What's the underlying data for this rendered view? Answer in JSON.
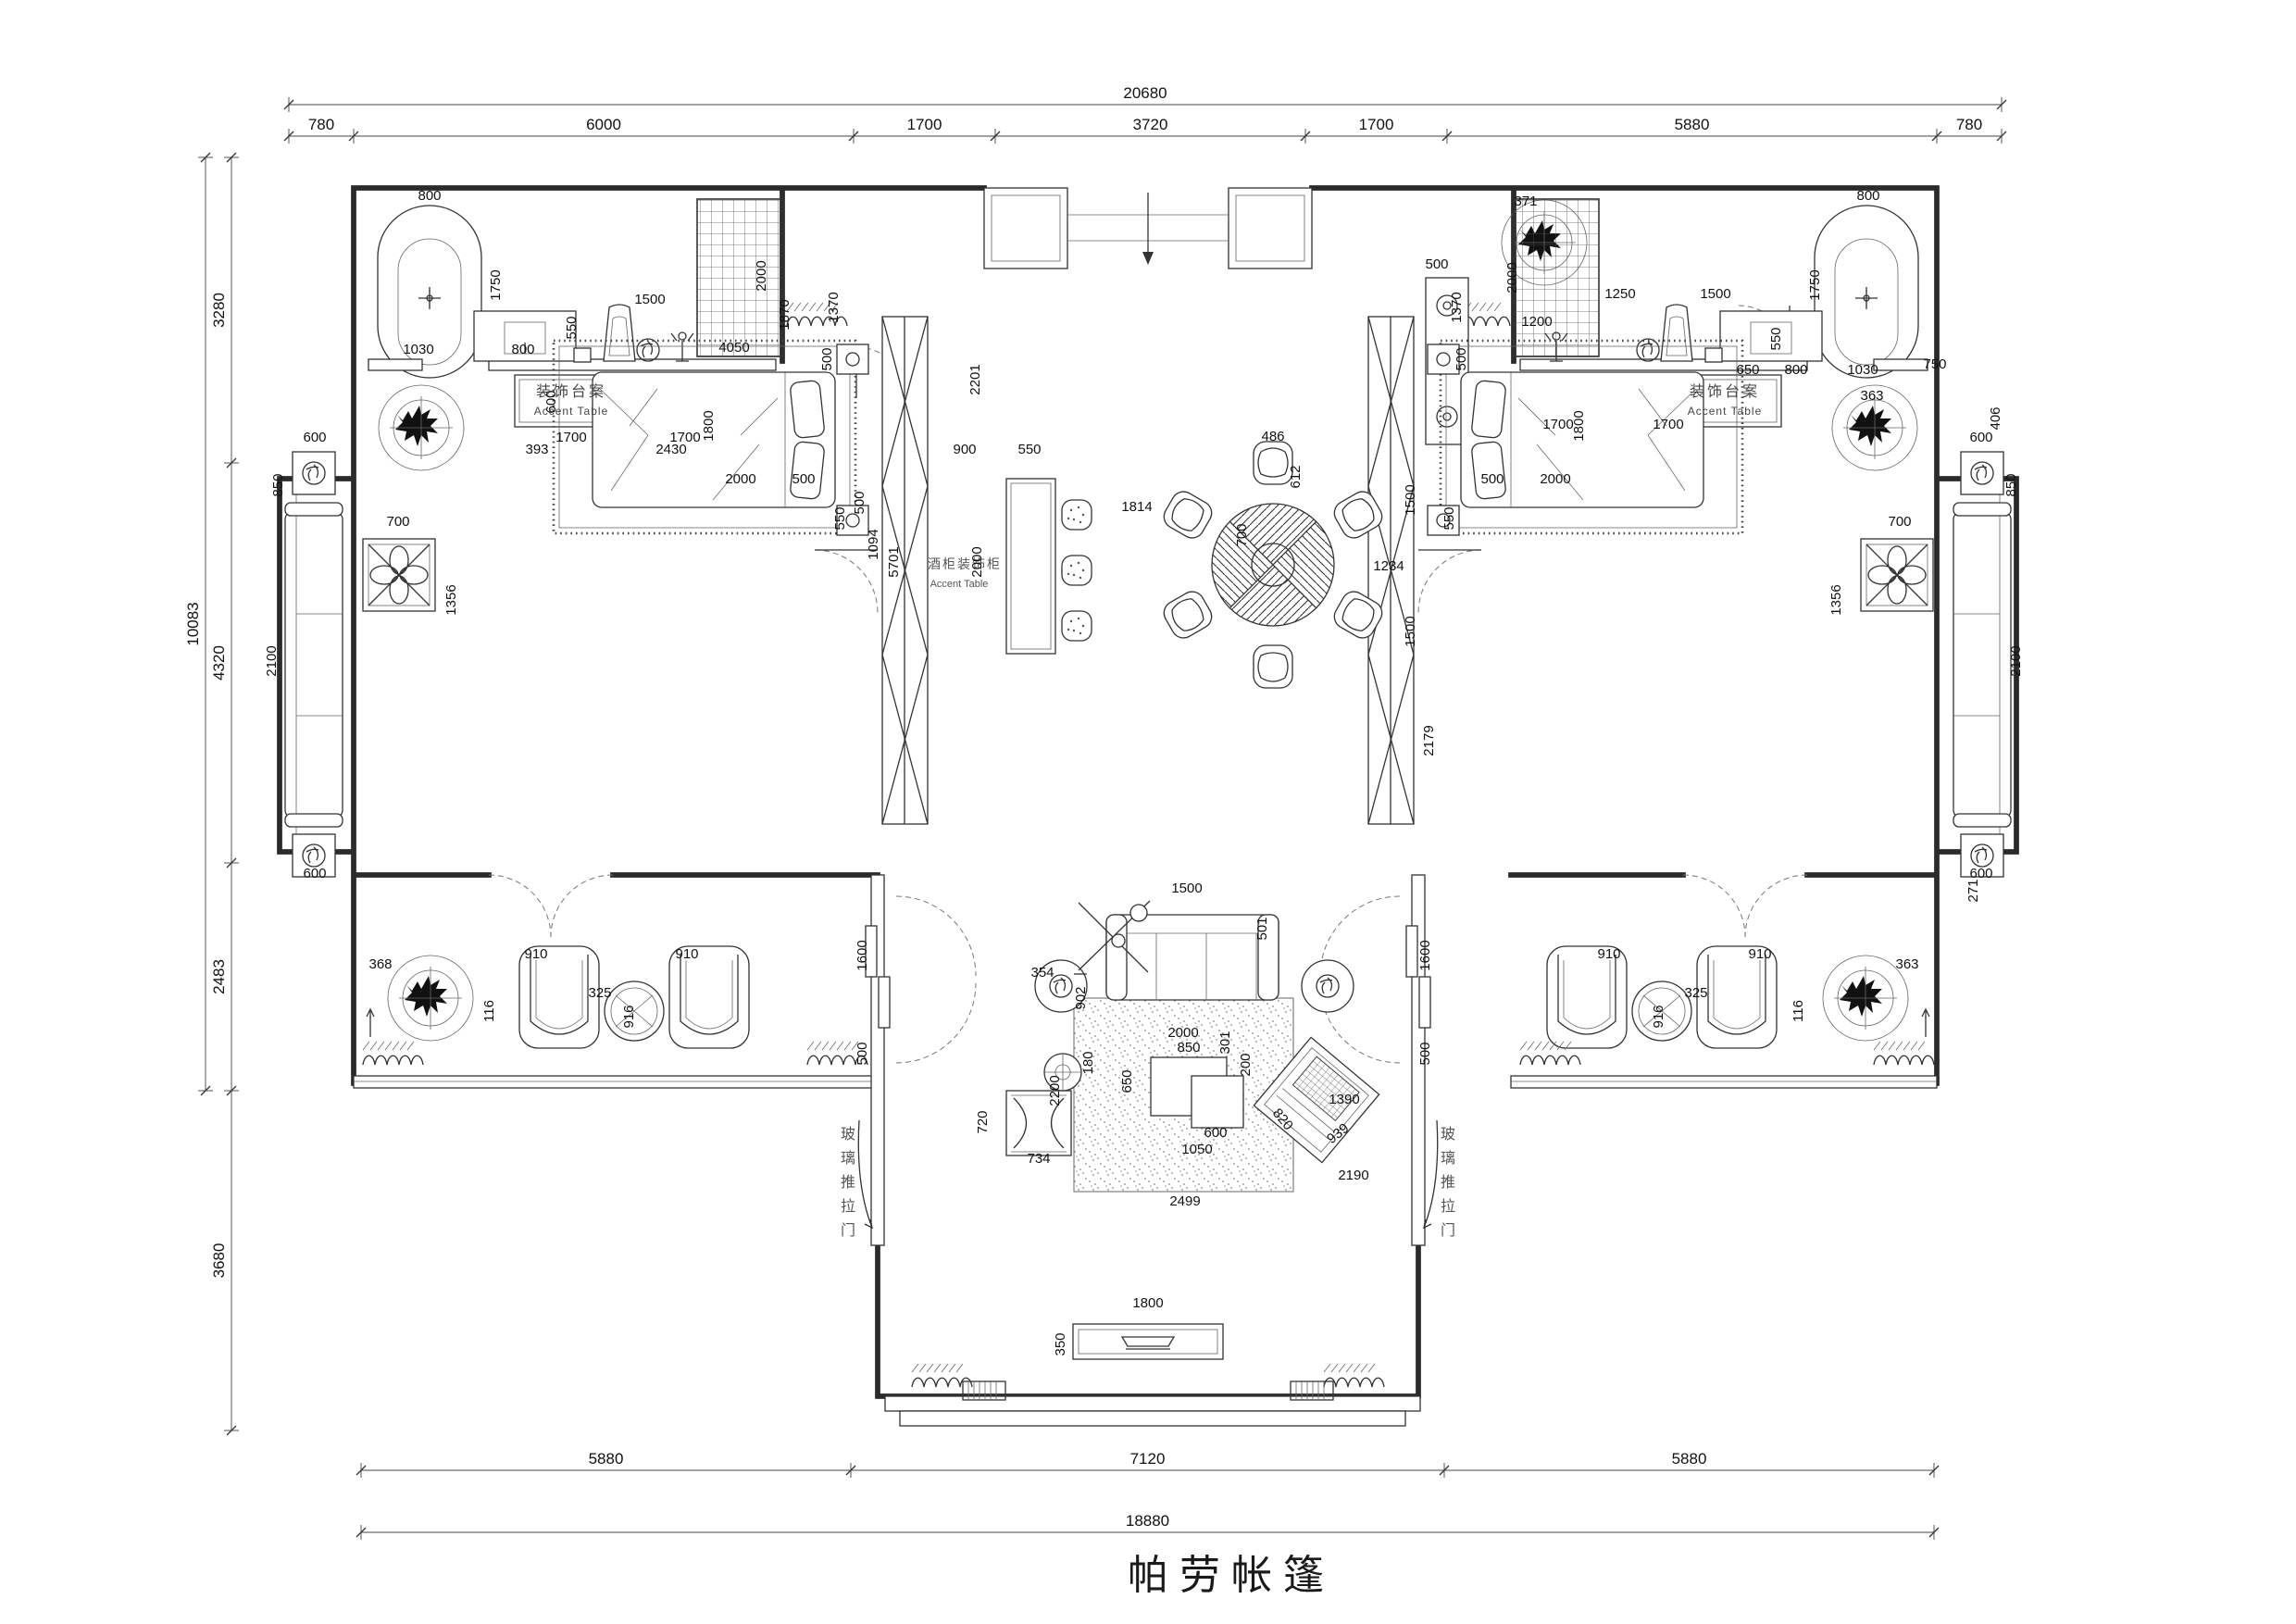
{
  "title": "帕劳帐篷",
  "labels": {
    "accent_table_left_zh": "装饰台案",
    "accent_table_left_en": "Accent Table",
    "accent_table_right_zh": "装饰台案",
    "accent_table_right_en": "Accent Table",
    "wine_cabinet_zh": "酒柜装饰柜",
    "wine_cabinet_en": "Accent Table",
    "glass_door_left": "玻璃推拉门",
    "glass_door_right": "玻璃推拉门"
  },
  "chains": {
    "top": {
      "total": "20680",
      "segments": [
        "780",
        "6000",
        "1700",
        "3720",
        "1700",
        "5880",
        "780"
      ],
      "x_ticks": [
        312,
        382,
        922,
        1075,
        1410,
        1563,
        2092,
        2162
      ],
      "line_seg_y": 147,
      "line_total_y": 113
    },
    "left": {
      "total": "10083",
      "segments": [
        "3280",
        "4320",
        "2483",
        "3680"
      ],
      "y_ticks": [
        170,
        500,
        932,
        1178,
        1545
      ],
      "line_seg_x": 250,
      "line_total_x": 222,
      "total_span": [
        170,
        1178
      ]
    },
    "bottom": {
      "total": "18880",
      "segments": [
        "5880",
        "7120",
        "5880"
      ],
      "x_ticks": [
        390,
        919,
        1560,
        2089
      ],
      "line_seg_y": 1588,
      "line_total_y": 1655
    }
  },
  "glass_doors": [
    {
      "text": "玻璃推拉门",
      "x": 916,
      "y": 1230
    },
    {
      "text": "玻璃推拉门",
      "x": 1564,
      "y": 1230
    }
  ],
  "plan_dims": [
    {
      "t": "800",
      "x": 464,
      "y": 216
    },
    {
      "t": "1750",
      "x": 540,
      "y": 308,
      "r": -90
    },
    {
      "t": "1030",
      "x": 452,
      "y": 382
    },
    {
      "t": "800",
      "x": 565,
      "y": 382
    },
    {
      "t": "550",
      "x": 622,
      "y": 354,
      "r": -90
    },
    {
      "t": "1500",
      "x": 702,
      "y": 328
    },
    {
      "t": "4050",
      "x": 793,
      "y": 380
    },
    {
      "t": "600",
      "x": 600,
      "y": 434,
      "r": -90
    },
    {
      "t": "1700",
      "x": 617,
      "y": 477
    },
    {
      "t": "1700",
      "x": 740,
      "y": 477
    },
    {
      "t": "2000",
      "x": 827,
      "y": 298,
      "r": -90
    },
    {
      "t": "1870",
      "x": 852,
      "y": 340,
      "r": -90
    },
    {
      "t": "1370",
      "x": 905,
      "y": 332,
      "r": -90
    },
    {
      "t": "2201",
      "x": 1058,
      "y": 410,
      "r": -90
    },
    {
      "t": "900",
      "x": 1042,
      "y": 490
    },
    {
      "t": "550",
      "x": 1112,
      "y": 490
    },
    {
      "t": "500",
      "x": 898,
      "y": 388,
      "r": -90
    },
    {
      "t": "1800",
      "x": 770,
      "y": 460,
      "r": -90
    },
    {
      "t": "2000",
      "x": 800,
      "y": 522
    },
    {
      "t": "500",
      "x": 868,
      "y": 522
    },
    {
      "t": "550",
      "x": 912,
      "y": 560,
      "r": -90
    },
    {
      "t": "500",
      "x": 933,
      "y": 543,
      "r": -90
    },
    {
      "t": "1094",
      "x": 948,
      "y": 588,
      "r": -90
    },
    {
      "t": "2430",
      "x": 725,
      "y": 490
    },
    {
      "t": "393",
      "x": 580,
      "y": 490
    },
    {
      "t": "600",
      "x": 340,
      "y": 477
    },
    {
      "t": "850",
      "x": 305,
      "y": 524,
      "r": -90
    },
    {
      "t": "700",
      "x": 430,
      "y": 568
    },
    {
      "t": "1356",
      "x": 492,
      "y": 648,
      "r": -90
    },
    {
      "t": "2100",
      "x": 298,
      "y": 714,
      "r": -90
    },
    {
      "t": "600",
      "x": 340,
      "y": 948
    },
    {
      "t": "368",
      "x": 411,
      "y": 1046
    },
    {
      "t": "910",
      "x": 579,
      "y": 1035
    },
    {
      "t": "910",
      "x": 742,
      "y": 1035
    },
    {
      "t": "325",
      "x": 648,
      "y": 1077
    },
    {
      "t": "116",
      "x": 533,
      "y": 1092,
      "r": -90
    },
    {
      "t": "916",
      "x": 684,
      "y": 1098,
      "r": -90
    },
    {
      "t": "1600",
      "x": 936,
      "y": 1032,
      "r": -90
    },
    {
      "t": "500",
      "x": 936,
      "y": 1138,
      "r": -90
    },
    {
      "t": "486",
      "x": 1375,
      "y": 476
    },
    {
      "t": "612",
      "x": 1404,
      "y": 515,
      "r": -90
    },
    {
      "t": "700",
      "x": 1346,
      "y": 578,
      "r": -90
    },
    {
      "t": "1814",
      "x": 1228,
      "y": 552
    },
    {
      "t": "1234",
      "x": 1500,
      "y": 616
    },
    {
      "t": "1500",
      "x": 1528,
      "y": 540,
      "r": -90
    },
    {
      "t": "1500",
      "x": 1528,
      "y": 682,
      "r": -90
    },
    {
      "t": "500",
      "x": 1552,
      "y": 290
    },
    {
      "t": "2179",
      "x": 1548,
      "y": 800,
      "r": -90
    },
    {
      "t": "2000",
      "x": 1060,
      "y": 607,
      "r": -90
    },
    {
      "t": "5701",
      "x": 970,
      "y": 607,
      "r": -90
    },
    {
      "t": "371",
      "x": 1648,
      "y": 222
    },
    {
      "t": "2000",
      "x": 1638,
      "y": 300,
      "r": -90
    },
    {
      "t": "1200",
      "x": 1660,
      "y": 352
    },
    {
      "t": "1250",
      "x": 1750,
      "y": 322
    },
    {
      "t": "1500",
      "x": 1853,
      "y": 322
    },
    {
      "t": "550",
      "x": 1923,
      "y": 366,
      "r": -90
    },
    {
      "t": "650",
      "x": 1888,
      "y": 404
    },
    {
      "t": "800",
      "x": 1940,
      "y": 404
    },
    {
      "t": "1030",
      "x": 2012,
      "y": 404
    },
    {
      "t": "363",
      "x": 2022,
      "y": 432
    },
    {
      "t": "1700",
      "x": 1683,
      "y": 463
    },
    {
      "t": "1700",
      "x": 1802,
      "y": 463
    },
    {
      "t": "1750",
      "x": 1965,
      "y": 308,
      "r": -90
    },
    {
      "t": "800",
      "x": 2018,
      "y": 216
    },
    {
      "t": "1370",
      "x": 1578,
      "y": 332,
      "r": -90
    },
    {
      "t": "500",
      "x": 1583,
      "y": 388,
      "r": -90
    },
    {
      "t": "1800",
      "x": 1710,
      "y": 460,
      "r": -90
    },
    {
      "t": "2000",
      "x": 1680,
      "y": 522
    },
    {
      "t": "500",
      "x": 1612,
      "y": 522
    },
    {
      "t": "550",
      "x": 1570,
      "y": 560,
      "r": -90
    },
    {
      "t": "600",
      "x": 2140,
      "y": 477
    },
    {
      "t": "850",
      "x": 2177,
      "y": 524,
      "r": -90
    },
    {
      "t": "750",
      "x": 2090,
      "y": 398
    },
    {
      "t": "700",
      "x": 2052,
      "y": 568
    },
    {
      "t": "1356",
      "x": 1988,
      "y": 648,
      "r": -90
    },
    {
      "t": "406",
      "x": 2160,
      "y": 452,
      "r": -90
    },
    {
      "t": "2100",
      "x": 2182,
      "y": 714,
      "r": -90
    },
    {
      "t": "600",
      "x": 2140,
      "y": 948
    },
    {
      "t": "271",
      "x": 2136,
      "y": 962,
      "r": -90
    },
    {
      "t": "363",
      "x": 2060,
      "y": 1046
    },
    {
      "t": "910",
      "x": 1738,
      "y": 1035
    },
    {
      "t": "910",
      "x": 1901,
      "y": 1035
    },
    {
      "t": "325",
      "x": 1832,
      "y": 1077
    },
    {
      "t": "116",
      "x": 1947,
      "y": 1092,
      "r": -90
    },
    {
      "t": "916",
      "x": 1796,
      "y": 1098,
      "r": -90
    },
    {
      "t": "1600",
      "x": 1544,
      "y": 1032,
      "r": -90
    },
    {
      "t": "500",
      "x": 1544,
      "y": 1138,
      "r": -90
    },
    {
      "t": "1500",
      "x": 1282,
      "y": 964
    },
    {
      "t": "501",
      "x": 1368,
      "y": 1003,
      "r": -90
    },
    {
      "t": "354",
      "x": 1126,
      "y": 1055
    },
    {
      "t": "902",
      "x": 1172,
      "y": 1078,
      "r": -90
    },
    {
      "t": "2000",
      "x": 1278,
      "y": 1120
    },
    {
      "t": "850",
      "x": 1284,
      "y": 1136
    },
    {
      "t": "301",
      "x": 1328,
      "y": 1126,
      "r": -90
    },
    {
      "t": "180",
      "x": 1180,
      "y": 1148,
      "r": -90
    },
    {
      "t": "2200",
      "x": 1144,
      "y": 1178,
      "r": -90
    },
    {
      "t": "650",
      "x": 1222,
      "y": 1168,
      "r": -90
    },
    {
      "t": "200",
      "x": 1350,
      "y": 1150,
      "r": -90
    },
    {
      "t": "600",
      "x": 1313,
      "y": 1228
    },
    {
      "t": "1050",
      "x": 1293,
      "y": 1246
    },
    {
      "t": "820",
      "x": 1382,
      "y": 1212,
      "r": 50
    },
    {
      "t": "939",
      "x": 1448,
      "y": 1228,
      "r": -38
    },
    {
      "t": "734",
      "x": 1122,
      "y": 1256
    },
    {
      "t": "720",
      "x": 1066,
      "y": 1212,
      "r": -90
    },
    {
      "t": "2499",
      "x": 1280,
      "y": 1302
    },
    {
      "t": "2190",
      "x": 1462,
      "y": 1274
    },
    {
      "t": "1390",
      "x": 1452,
      "y": 1192
    },
    {
      "t": "1800",
      "x": 1240,
      "y": 1412
    },
    {
      "t": "350",
      "x": 1150,
      "y": 1452,
      "r": -90
    }
  ]
}
